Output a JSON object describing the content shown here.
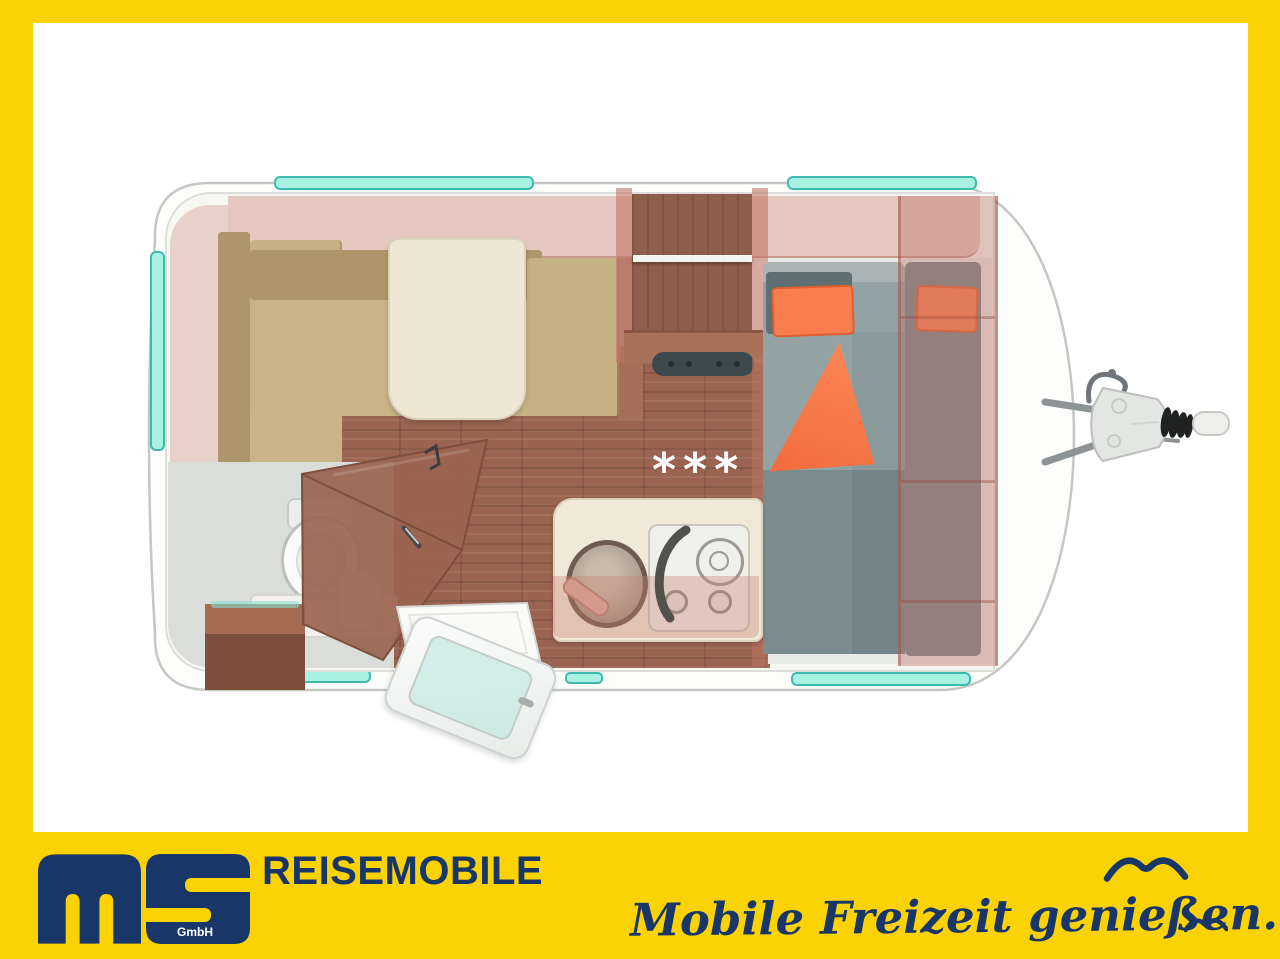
{
  "branding": {
    "logo_text": "ms",
    "logo_suffix": "GmbH",
    "division": "REISEMOBILE",
    "slogan": "Mobile Freizeit genießen.",
    "colors": {
      "brand_yellow": "#FBD304",
      "brand_navy": "#183768"
    }
  },
  "floorplan": {
    "view": "caravan-top-view-3d-cutaway",
    "floor_marking": "***",
    "features": [
      "front-dinette-l-shaped",
      "dining-table",
      "left-side-window",
      "front-windows",
      "wardrobe-with-rail",
      "heater-control-bar",
      "kitchen-round-sink",
      "gas-stove-two-knobs",
      "wet-bath-toilet",
      "bath-bench",
      "step-box",
      "diagonal-bath-door",
      "entry-door-open",
      "french-bed-gray",
      "orange-pillows",
      "orange-blanket",
      "rear-side-seat",
      "rear-shelving-unit",
      "rear-windows",
      "tow-hitch-drawbar"
    ],
    "colors": {
      "window_teal": "#A9F1E3",
      "wood": "#9A6450",
      "upholstery_tan": "#C6B184",
      "mattress_gray": "#93A3A3",
      "accent_orange": "#F97E4F",
      "table_cream": "#EFE7D4",
      "body_white": "#FDFDFB"
    }
  }
}
